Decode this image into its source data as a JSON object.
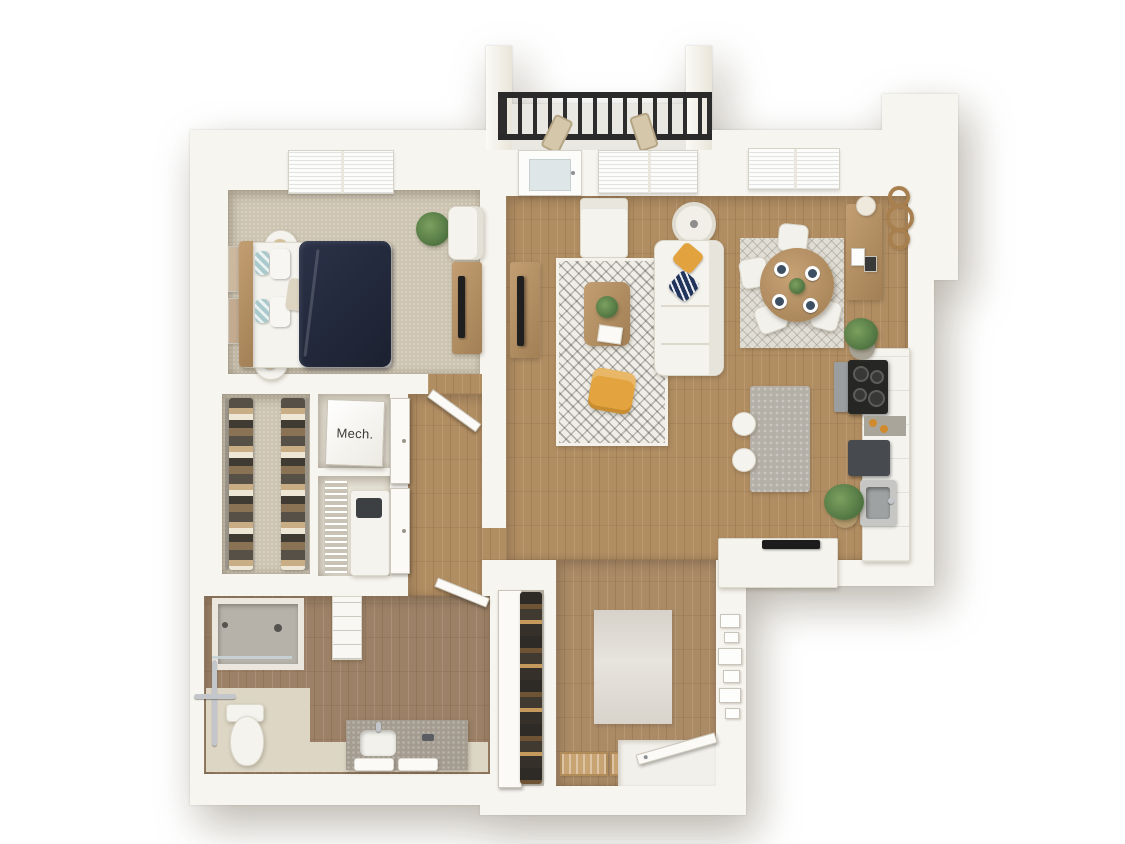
{
  "title": "3D apartment floor plan, top-down view",
  "labels": {
    "mech_room": "Mech."
  },
  "colors": {
    "background": "#ffffff",
    "wall": "#f7f5ef",
    "wood_floor": "#b18d62",
    "entry_wood_floor": "#ab8a66",
    "bathroom_wood_floor": "#9c8166",
    "carpet": "#cdc4b2",
    "balcony_railing": "#2d2d2d",
    "duvet_navy": "#222838",
    "accent_yellow": "#e2a33f",
    "pillow_teal": "#a9c9cc",
    "island_stone": "#b5b0a7",
    "cabinet_white": "#f4f3ee",
    "appliance_dark": "#2a2a28",
    "plant_green": "#5f7f50",
    "wood_furniture": "#b3905f"
  },
  "rooms": [
    {
      "name": "balcony"
    },
    {
      "name": "bedroom"
    },
    {
      "name": "living-room"
    },
    {
      "name": "dining-area"
    },
    {
      "name": "kitchen"
    },
    {
      "name": "walk-in-closet"
    },
    {
      "name": "mechanical-closet",
      "label": "Mech."
    },
    {
      "name": "laundry-closet"
    },
    {
      "name": "hallway"
    },
    {
      "name": "bathroom"
    },
    {
      "name": "coat-closet"
    },
    {
      "name": "entry-hall"
    }
  ],
  "furniture": [
    "balcony-chairs",
    "queen-bed",
    "navy-duvet",
    "nightstands",
    "table-lamps",
    "wall-art",
    "bedroom-armchair",
    "dresser-with-tv",
    "potted-plants",
    "sofa",
    "throw-pillows",
    "coffee-table",
    "living-area-rug",
    "yellow-accent-chair",
    "floor-lamp",
    "tv-console",
    "media-cabinet",
    "round-dining-table",
    "dining-chairs",
    "place-settings",
    "sideboard",
    "wall-rings-decor",
    "kitchen-island",
    "bar-stools",
    "range-cooktop",
    "kitchen-sink",
    "counter-appliance",
    "peninsula-counter",
    "washer-dryer",
    "wire-shelving",
    "hanging-clothes",
    "water-heater",
    "walk-in-shower",
    "grab-bars",
    "toilet",
    "vanity-with-sink",
    "towels",
    "linen-shelf",
    "coat-closet-clothes",
    "entry-rug",
    "doormats",
    "entry-door",
    "gallery-wall-frames"
  ]
}
